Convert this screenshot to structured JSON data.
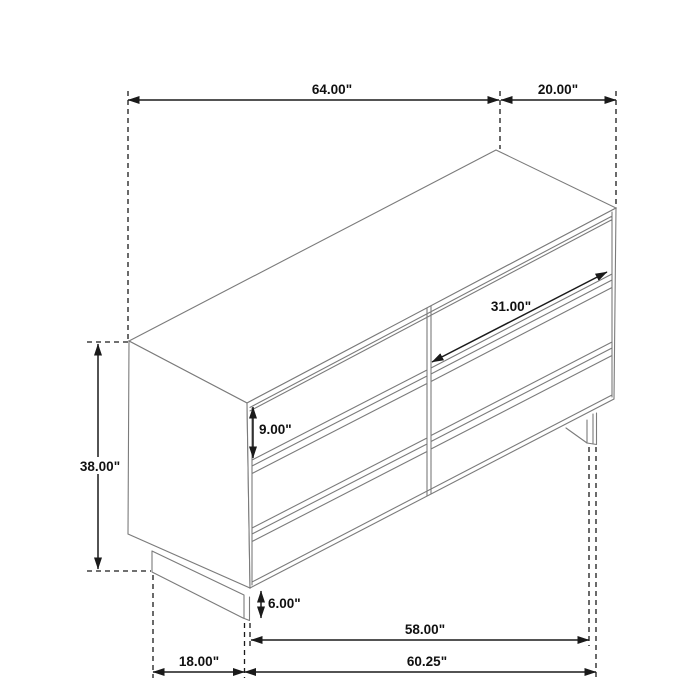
{
  "title": "Inner Size of Drawer : 29.00\"W X 12.75\"D X 6.25\"H X 0.50\"T",
  "product": {
    "kind": "six-drawer dresser line drawing",
    "drawers_visible": 6
  },
  "dims": {
    "width_top": "64.00\"",
    "depth_top": "20.00\"",
    "height": "38.00\"",
    "drawer_width": "31.00\"",
    "drawer_height": "9.00\"",
    "leg_height": "6.00\"",
    "front_span": "58.00\"",
    "base_width": "60.25\"",
    "side_depth": "18.00\""
  },
  "colors": {
    "background": "#ffffff",
    "furniture_line": "#7b7b7b",
    "dimension_line": "#1a1a1a",
    "text": "#111111"
  }
}
